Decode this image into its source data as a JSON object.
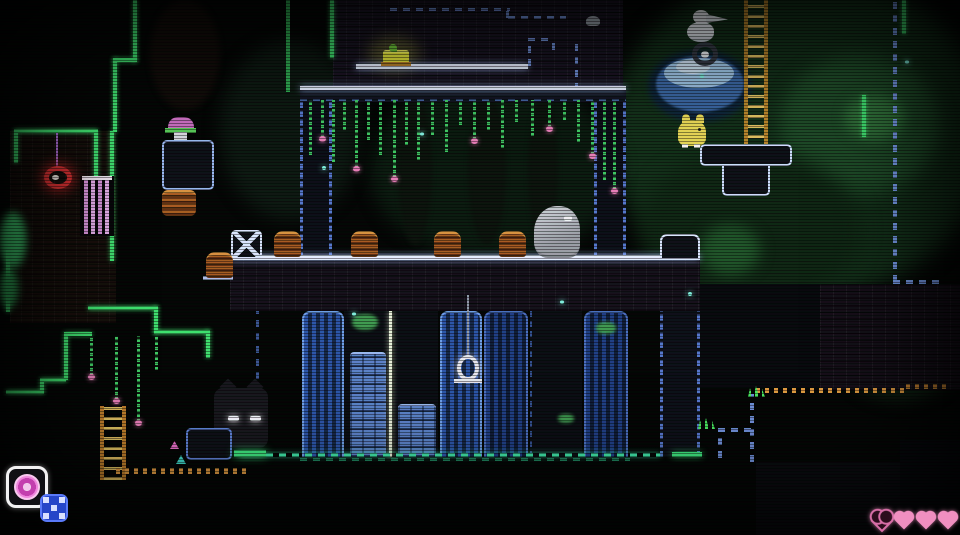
{
  "meta": {
    "label": "dark pixel-art platformer scene: ruined well temple with columns, vines, animals and CRT scanlines",
    "viewport": {
      "width": 960,
      "height": 535
    }
  },
  "palette": {
    "background": "#030503",
    "outline_white_blue": "#e6eeff",
    "outline_blue_dash": "#5577cc",
    "outline_green": "#3fe06e",
    "vine_green": "#3fc862",
    "flower_pink": "#e87fb8",
    "cyan_floor_dash": "#3fe8a8",
    "pillar_stripe_blue": "#2c55a8",
    "pillar_brick_blue": "#5b82c8",
    "ladder_orange": "#d8b048",
    "critter_brown": "#a85c20",
    "creature_gray": "#b4b8be",
    "creature_yellow": "#e8d855",
    "item_yellow": "#e8e83a",
    "red_lamp": "#e03030",
    "pool_blue": "#9cc4e4",
    "hud_item_pink": "#d84fc0",
    "hud_badge_blue": "#2646c8",
    "heart_pink": "#f08fc0"
  },
  "hud": {
    "item_slot": {
      "icon": "firecracker-disc-icon",
      "frame_color": "#f2f2f2"
    },
    "count_badge": {
      "icon": "x-pips-icon",
      "color": "#2646c8"
    },
    "hearts": {
      "total": 4,
      "states": [
        "empty",
        "full",
        "full",
        "full"
      ]
    }
  },
  "scene": {
    "entities": [
      "temple-top-wall",
      "glowing-yellow-item",
      "top-platform",
      "left-column",
      "right-column",
      "main-platform",
      "x-crate",
      "brown-critters",
      "gray-creature",
      "well-cells",
      "hanging-lantern",
      "red-ring-lamp",
      "pink-gate-bars",
      "pink-mushroom-block",
      "orange-basket",
      "cat-with-glowing-eyes",
      "white-bird",
      "ring-wreath",
      "water-pool",
      "tall-ladder",
      "small-ladder",
      "yellow-creature",
      "pedestal-platform",
      "hearts-hud",
      "item-hud"
    ],
    "critters": [
      {
        "x": 206,
        "y": 252
      },
      {
        "x": 274,
        "y": 231
      },
      {
        "x": 351,
        "y": 231
      },
      {
        "x": 434,
        "y": 231
      },
      {
        "x": 499,
        "y": 231
      }
    ],
    "top_vines": [
      {
        "x": 4,
        "h": 55,
        "f": 0
      },
      {
        "x": 16,
        "h": 38,
        "f": 1
      },
      {
        "x": 27,
        "h": 62,
        "f": 0
      },
      {
        "x": 38,
        "h": 30,
        "f": 0
      },
      {
        "x": 50,
        "h": 68,
        "f": 1
      },
      {
        "x": 62,
        "h": 40,
        "f": 0
      },
      {
        "x": 74,
        "h": 55,
        "f": 0
      },
      {
        "x": 88,
        "h": 78,
        "f": 1
      },
      {
        "x": 100,
        "h": 45,
        "f": 0
      },
      {
        "x": 112,
        "h": 60,
        "f": 0
      },
      {
        "x": 126,
        "h": 35,
        "f": 0
      },
      {
        "x": 140,
        "h": 52,
        "f": 0
      },
      {
        "x": 154,
        "h": 25,
        "f": 0
      },
      {
        "x": 168,
        "h": 40,
        "f": 1
      },
      {
        "x": 182,
        "h": 30,
        "f": 0
      },
      {
        "x": 196,
        "h": 48,
        "f": 0
      },
      {
        "x": 210,
        "h": 22,
        "f": 0
      },
      {
        "x": 226,
        "h": 36,
        "f": 0
      },
      {
        "x": 243,
        "h": 28,
        "f": 1
      },
      {
        "x": 258,
        "h": 20,
        "f": 0
      },
      {
        "x": 272,
        "h": 42,
        "f": 0
      },
      {
        "x": 286,
        "h": 55,
        "f": 1
      },
      {
        "x": 298,
        "h": 80,
        "f": 0
      },
      {
        "x": 308,
        "h": 90,
        "f": 1
      }
    ],
    "left_vines": [
      {
        "x": 5,
        "h": 40,
        "f": 1
      },
      {
        "x": 30,
        "h": 64,
        "f": 1
      },
      {
        "x": 52,
        "h": 86,
        "f": 1
      },
      {
        "x": 70,
        "h": 34,
        "f": 0
      }
    ],
    "sparkles": [
      {
        "x": 322,
        "y": 166
      },
      {
        "x": 352,
        "y": 312
      },
      {
        "x": 688,
        "y": 292
      },
      {
        "x": 420,
        "y": 132
      },
      {
        "x": 560,
        "y": 300
      },
      {
        "x": 905,
        "y": 60
      },
      {
        "x": 700,
        "y": 74
      }
    ],
    "grass_tufts": [
      {
        "x": 698,
        "y": 418
      },
      {
        "x": 748,
        "y": 386
      }
    ]
  }
}
